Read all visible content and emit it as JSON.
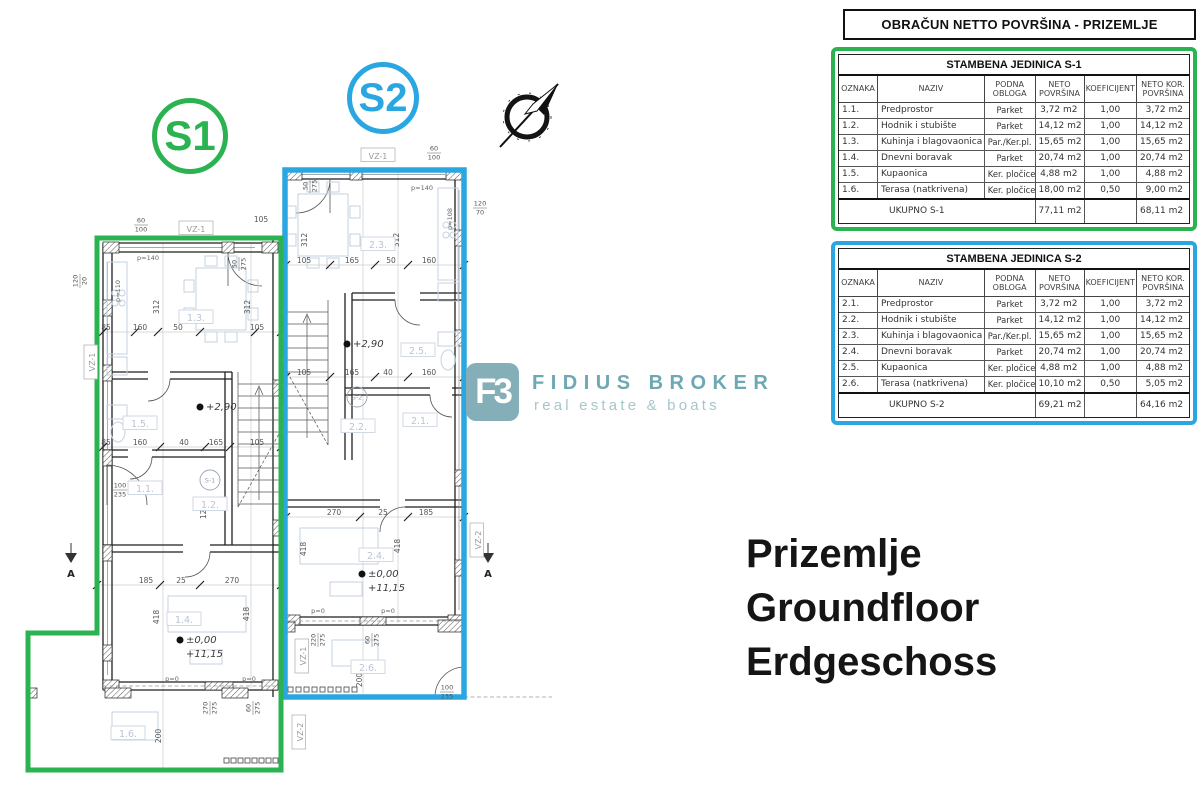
{
  "title": {
    "text": "OBRAČUN NETTO POVRŠINA - PRIZEMLJE"
  },
  "tables": [
    {
      "id": "s1",
      "accent": "#2bb351",
      "title": "STAMBENA JEDINICA S-1",
      "columns": [
        "OZNAKA",
        "NAZIV",
        "PODNA\nOBLOGA",
        "NETO\nPOVRŠINA",
        "KOEFICIJENT",
        "NETO KOR.\nPOVRŠINA"
      ],
      "rows": [
        [
          "1.1.",
          "Predprostor",
          "Parket",
          "3,72 m2",
          "1,00",
          "3,72 m2"
        ],
        [
          "1.2.",
          "Hodnik i stubište",
          "Parket",
          "14,12 m2",
          "1,00",
          "14,12 m2"
        ],
        [
          "1.3.",
          "Kuhinja i blagovaonica",
          "Par./Ker.pl.",
          "15,65 m2",
          "1,00",
          "15,65 m2"
        ],
        [
          "1.4.",
          "Dnevni boravak",
          "Parket",
          "20,74 m2",
          "1,00",
          "20,74 m2"
        ],
        [
          "1.5.",
          "Kupaonica",
          "Ker. pločice",
          "4,88 m2",
          "1,00",
          "4,88 m2"
        ],
        [
          "1.6.",
          "Terasa (natkrivena)",
          "Ker. pločice",
          "18,00 m2",
          "0,50",
          "9,00 m2"
        ]
      ],
      "total": {
        "label": "UKUPNO S-1",
        "neto": "77,11 m2",
        "koef": "",
        "neto_kor": "68,11 m2"
      }
    },
    {
      "id": "s2",
      "accent": "#2aa7e0",
      "title": "STAMBENA JEDINICA S-2",
      "columns": [
        "OZNAKA",
        "NAZIV",
        "PODNA\nOBLOGA",
        "NETO\nPOVRŠINA",
        "KOEFICIJENT",
        "NETO KOR.\nPOVRŠINA"
      ],
      "rows": [
        [
          "2.1.",
          "Predprostor",
          "Parket",
          "3,72 m2",
          "1,00",
          "3,72 m2"
        ],
        [
          "2.2.",
          "Hodnik i stubište",
          "Parket",
          "14,12 m2",
          "1,00",
          "14,12 m2"
        ],
        [
          "2.3.",
          "Kuhinja i blagovaonica",
          "Par./Ker.pl.",
          "15,65 m2",
          "1,00",
          "15,65 m2"
        ],
        [
          "2.4.",
          "Dnevni boravak",
          "Parket",
          "20,74 m2",
          "1,00",
          "20,74 m2"
        ],
        [
          "2.5.",
          "Kupaonica",
          "Ker. pločice",
          "4,88 m2",
          "1,00",
          "4,88 m2"
        ],
        [
          "2.6.",
          "Terasa (natkrivena)",
          "Ker. pločice",
          "10,10 m2",
          "0,50",
          "5,05 m2"
        ]
      ],
      "total": {
        "label": "UKUPNO S-2",
        "neto": "69,21 m2",
        "koef": "",
        "neto_kor": "64,16 m2"
      }
    }
  ],
  "logo": {
    "mark": "F3",
    "name": "FIDIUS BROKER",
    "tagline": "real estate & boats",
    "teal": "#85afb8",
    "name_color": "#6ea8b3"
  },
  "headline": {
    "lines": [
      "Prizemlje",
      "Groundfloor",
      "Erdgeschoss"
    ]
  },
  "floorplan": {
    "colors": {
      "s1": "#2bb351",
      "s2": "#2aa7e0"
    },
    "badges": [
      {
        "label": "S1",
        "color": "#2bb351"
      },
      {
        "label": "S2",
        "color": "#2aa7e0"
      }
    ],
    "annotations": [
      {
        "c": "dim",
        "t": "105",
        "x": 261,
        "y": 222
      },
      {
        "c": "dim",
        "t": "85",
        "x": 106,
        "y": 330
      },
      {
        "c": "dim",
        "t": "160",
        "x": 140,
        "y": 330
      },
      {
        "c": "dim",
        "t": "50",
        "x": 178,
        "y": 330
      },
      {
        "c": "dim",
        "t": "105",
        "x": 257,
        "y": 330
      },
      {
        "c": "dim",
        "t": "312",
        "x": 159,
        "y": 307,
        "r": -90
      },
      {
        "c": "dim",
        "t": "312",
        "x": 250,
        "y": 307,
        "r": -90
      },
      {
        "c": "dim",
        "t": "85",
        "x": 106,
        "y": 445
      },
      {
        "c": "dim",
        "t": "160",
        "x": 140,
        "y": 445
      },
      {
        "c": "dim",
        "t": "40",
        "x": 184,
        "y": 445
      },
      {
        "c": "dim",
        "t": "165",
        "x": 216,
        "y": 445
      },
      {
        "c": "dim",
        "t": "105",
        "x": 257,
        "y": 445
      },
      {
        "c": "dim",
        "t": "185",
        "x": 146,
        "y": 583
      },
      {
        "c": "dim",
        "t": "25",
        "x": 181,
        "y": 583
      },
      {
        "c": "dim",
        "t": "270",
        "x": 232,
        "y": 583
      },
      {
        "c": "dim",
        "t": "418",
        "x": 159,
        "y": 617,
        "r": -90
      },
      {
        "c": "dim",
        "t": "418",
        "x": 249,
        "y": 614,
        "r": -90
      },
      {
        "c": "dim",
        "t": "200",
        "x": 161,
        "y": 736,
        "r": -90
      },
      {
        "c": "dim",
        "t": "120",
        "x": 206,
        "y": 512,
        "r": -90
      },
      {
        "c": "dim",
        "t": "105",
        "x": 304,
        "y": 263
      },
      {
        "c": "dim",
        "t": "165",
        "x": 352,
        "y": 263
      },
      {
        "c": "dim",
        "t": "50",
        "x": 391,
        "y": 263
      },
      {
        "c": "dim",
        "t": "160",
        "x": 429,
        "y": 263
      },
      {
        "c": "dim",
        "t": "312",
        "x": 307,
        "y": 240,
        "r": -90
      },
      {
        "c": "dim",
        "t": "312",
        "x": 399,
        "y": 240,
        "r": -90
      },
      {
        "c": "dim",
        "t": "105",
        "x": 304,
        "y": 375
      },
      {
        "c": "dim",
        "t": "165",
        "x": 352,
        "y": 375
      },
      {
        "c": "dim",
        "t": "40",
        "x": 388,
        "y": 375
      },
      {
        "c": "dim",
        "t": "160",
        "x": 429,
        "y": 375
      },
      {
        "c": "dim",
        "t": "270",
        "x": 334,
        "y": 515
      },
      {
        "c": "dim",
        "t": "25",
        "x": 383,
        "y": 515
      },
      {
        "c": "dim",
        "t": "185",
        "x": 426,
        "y": 515
      },
      {
        "c": "dim",
        "t": "418",
        "x": 306,
        "y": 549,
        "r": -90
      },
      {
        "c": "dim",
        "t": "418",
        "x": 400,
        "y": 546,
        "r": -90
      },
      {
        "c": "dim",
        "t": "200",
        "x": 362,
        "y": 680,
        "r": -90
      },
      {
        "c": "room",
        "t": "1.1.",
        "x": 145,
        "y": 489
      },
      {
        "c": "room",
        "t": "1.2.",
        "x": 210,
        "y": 505
      },
      {
        "c": "room",
        "t": "1.3.",
        "x": 196,
        "y": 318
      },
      {
        "c": "room",
        "t": "1.4.",
        "x": 184,
        "y": 620
      },
      {
        "c": "room",
        "t": "1.5.",
        "x": 140,
        "y": 424
      },
      {
        "c": "room",
        "t": "1.6.",
        "x": 128,
        "y": 734
      },
      {
        "c": "room",
        "t": "2.1.",
        "x": 420,
        "y": 421
      },
      {
        "c": "room",
        "t": "2.2.",
        "x": 358,
        "y": 427
      },
      {
        "c": "room",
        "t": "2.3.",
        "x": 378,
        "y": 245
      },
      {
        "c": "room",
        "t": "2.4.",
        "x": 376,
        "y": 556
      },
      {
        "c": "room",
        "t": "2.5.",
        "x": 418,
        "y": 351
      },
      {
        "c": "room",
        "t": "2.6.",
        "x": 368,
        "y": 668
      },
      {
        "c": "elev",
        "t": "+2,90",
        "x": 210,
        "y": 410,
        "m": 1
      },
      {
        "c": "elev",
        "t": "±0,00",
        "x": 190,
        "y": 643,
        "m": 1
      },
      {
        "c": "elev",
        "t": "+11,15",
        "x": 190,
        "y": 657
      },
      {
        "c": "elev",
        "t": "+2,90",
        "x": 357,
        "y": 347,
        "m": 1
      },
      {
        "c": "elev",
        "t": "±0,00",
        "x": 372,
        "y": 577,
        "m": 1
      },
      {
        "c": "elev",
        "t": "+11,15",
        "x": 372,
        "y": 591
      },
      {
        "c": "vz",
        "t": "VZ-1",
        "x": 196,
        "y": 229
      },
      {
        "c": "vz",
        "t": "VZ-1",
        "x": 378,
        "y": 156
      },
      {
        "c": "vz",
        "t": "VZ-1",
        "x": 303,
        "y": 656,
        "r": -90
      },
      {
        "c": "vz",
        "t": "VZ-2",
        "x": 300,
        "y": 732,
        "r": -90
      },
      {
        "c": "vz",
        "t": "VZ-2",
        "x": 478,
        "y": 540,
        "r": -90
      },
      {
        "c": "vz",
        "t": "VZ-1",
        "x": 92,
        "y": 362,
        "r": -90
      },
      {
        "c": "pl",
        "t": "p=140",
        "x": 148,
        "y": 260
      },
      {
        "c": "pl",
        "t": "p=110",
        "x": 120,
        "y": 291,
        "r": -90
      },
      {
        "c": "pl",
        "t": "p=140",
        "x": 422,
        "y": 190
      },
      {
        "c": "pl",
        "t": "p=108",
        "x": 452,
        "y": 219,
        "r": -90
      },
      {
        "c": "pl",
        "t": "p=0",
        "x": 172,
        "y": 681
      },
      {
        "c": "pl",
        "t": "p=0",
        "x": 249,
        "y": 681
      },
      {
        "c": "pl",
        "t": "p=0",
        "x": 318,
        "y": 613
      },
      {
        "c": "pl",
        "t": "p=0",
        "x": 388,
        "y": 613
      },
      {
        "c": "stack",
        "t": "60\n100",
        "x": 141,
        "y": 224
      },
      {
        "c": "stack",
        "t": "60\n100",
        "x": 434,
        "y": 152
      },
      {
        "c": "stack",
        "t": "100\n235",
        "x": 120,
        "y": 489
      },
      {
        "c": "stack",
        "t": "100\n235",
        "x": 447,
        "y": 691
      },
      {
        "c": "stack",
        "t": "120\n20",
        "x": 79,
        "y": 281,
        "r": -90
      },
      {
        "c": "stack",
        "t": "50\n275",
        "x": 238,
        "y": 264,
        "r": -90
      },
      {
        "c": "stack",
        "t": "50\n275",
        "x": 309,
        "y": 186,
        "r": -90
      },
      {
        "c": "stack",
        "t": "120\n70",
        "x": 480,
        "y": 207
      },
      {
        "c": "stack",
        "t": "270\n275",
        "x": 209,
        "y": 708,
        "r": -90
      },
      {
        "c": "stack",
        "t": "60\n275",
        "x": 252,
        "y": 708,
        "r": -90
      },
      {
        "c": "stack",
        "t": "220\n275",
        "x": 317,
        "y": 640,
        "r": -90
      },
      {
        "c": "stack",
        "t": "60\n275",
        "x": 371,
        "y": 640,
        "r": -90
      },
      {
        "c": "mark",
        "t": "S-1",
        "x": 210,
        "y": 480
      },
      {
        "c": "mark",
        "t": "S-2",
        "x": 357,
        "y": 397
      },
      {
        "c": "sect",
        "t": "A",
        "x": 71,
        "y": 577
      },
      {
        "c": "sect",
        "t": "A",
        "x": 488,
        "y": 577
      }
    ]
  }
}
